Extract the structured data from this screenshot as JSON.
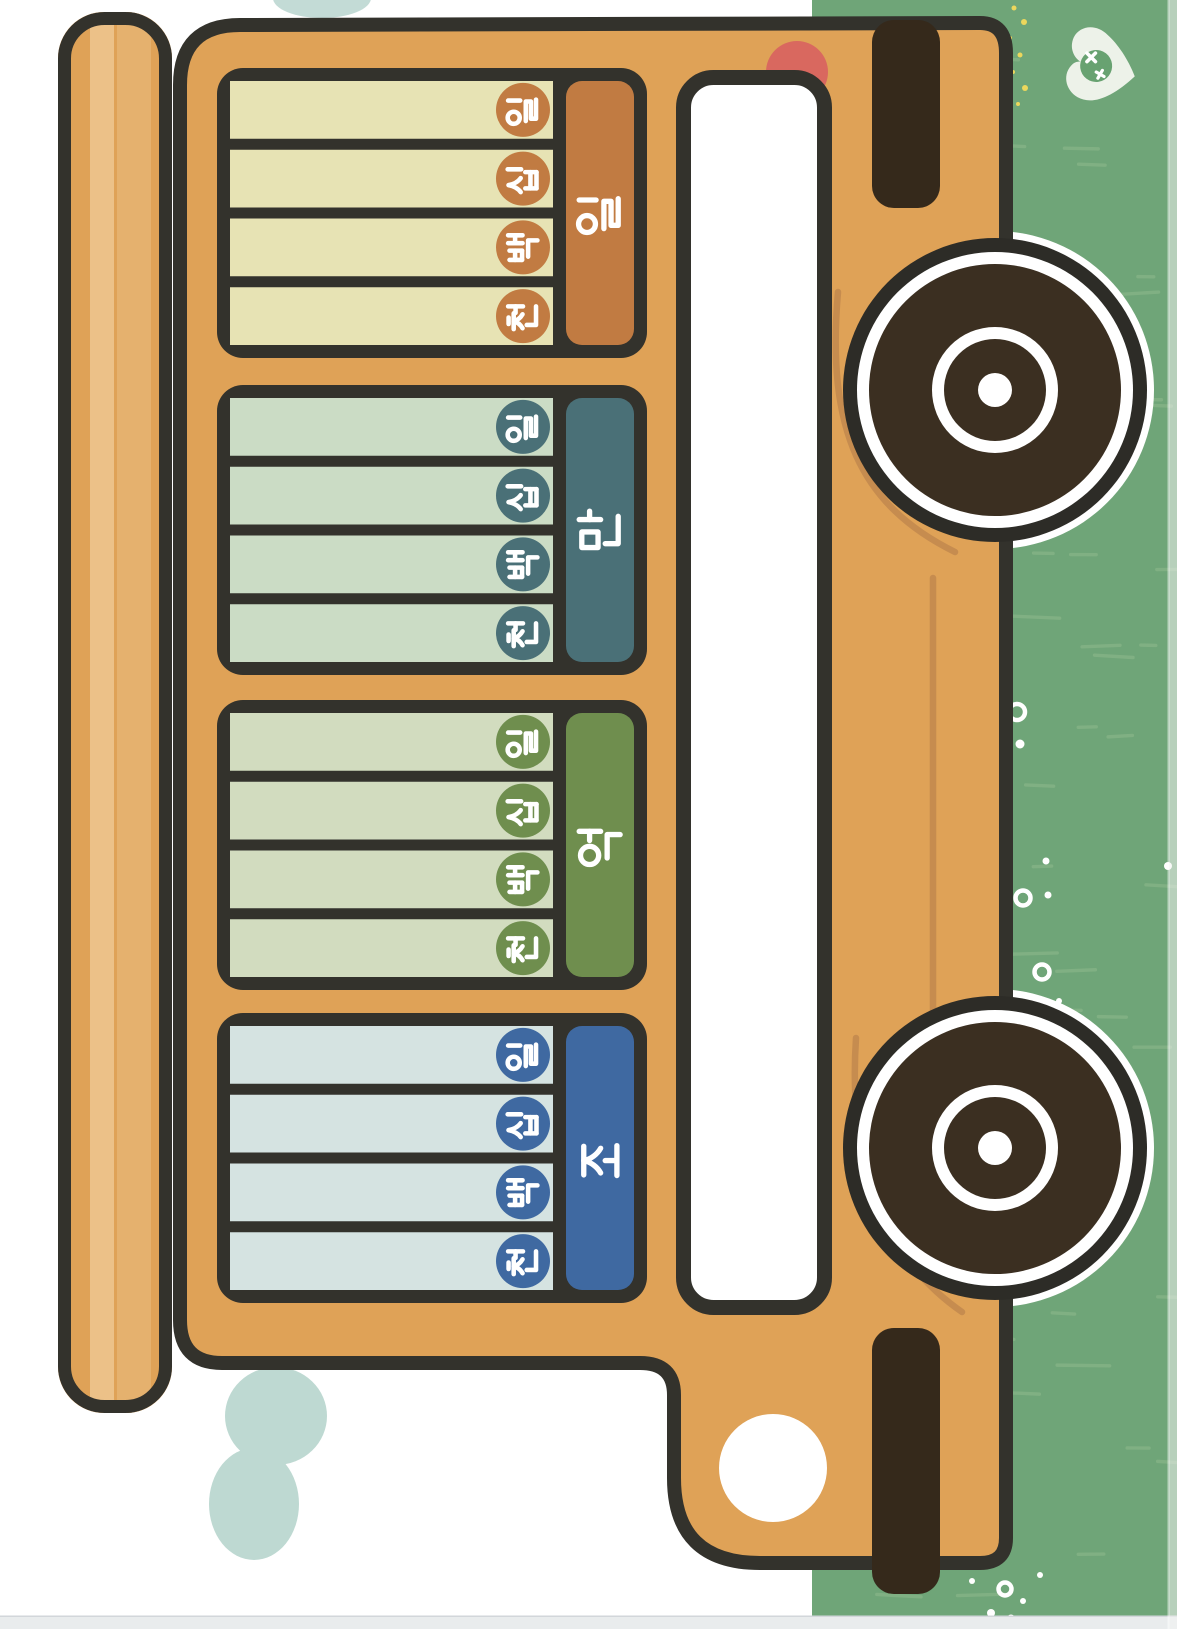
{
  "page": {
    "kind": "printable-worksheet",
    "background": "#ffffff",
    "bottom_edge_strip_color": "#e9eced"
  },
  "worksheet": {
    "theme": "korean-place-value-school-bus",
    "groups": [
      {
        "id": "il",
        "header_char": "일",
        "accent": "#c17b42",
        "row_fill": "#e7e3b4",
        "rows": [
          {
            "char": "일"
          },
          {
            "char": "십"
          },
          {
            "char": "백"
          },
          {
            "char": "천"
          }
        ]
      },
      {
        "id": "man",
        "header_char": "만",
        "accent": "#4a7077",
        "row_fill": "#cbdcc5",
        "rows": [
          {
            "char": "일"
          },
          {
            "char": "십"
          },
          {
            "char": "백"
          },
          {
            "char": "천"
          }
        ]
      },
      {
        "id": "eok",
        "header_char": "억",
        "accent": "#6f8e4e",
        "row_fill": "#d2dcbf",
        "rows": [
          {
            "char": "일"
          },
          {
            "char": "십"
          },
          {
            "char": "백"
          },
          {
            "char": "천"
          }
        ]
      },
      {
        "id": "jo",
        "header_char": "조",
        "accent": "#3f69a1",
        "row_fill": "#d5e3e1",
        "rows": [
          {
            "char": "일"
          },
          {
            "char": "십"
          },
          {
            "char": "백"
          },
          {
            "char": "천"
          }
        ]
      }
    ]
  },
  "bus": {
    "body_color": "#dfa257",
    "outline_color": "#33322c",
    "roof_stripe_colors": [
      "#ecc188",
      "#e5b16e"
    ],
    "window_color": "#ffffff",
    "wheel_dark_color": "#3b2f21",
    "wheel_rim_color": "#2d2c27",
    "bumper_color": "#35291b",
    "taillight_color": "#d9685f",
    "headlight_color": "#ffffff",
    "detail_line_color": "#c68c4f"
  },
  "scene": {
    "grass_color": "#6fa578",
    "grass_stroke_color": "#84b285",
    "smoke_color": "#bed9d2",
    "leaf_badge_color": "#edf2e9",
    "leaf_inner_color": "#68a271",
    "sparkle_dot_yellow": "#ecd75c",
    "dot_white": "#ffffff"
  },
  "icons": [
    "hangul-il-glyph",
    "hangul-sip-glyph",
    "hangul-baek-glyph",
    "hangul-cheon-glyph",
    "hangul-man-glyph",
    "hangul-eok-glyph",
    "hangul-jo-glyph",
    "wheel-icon",
    "leaf-badge-icon",
    "sparkle-x-icon",
    "headlight-icon",
    "taillight-icon",
    "bumper-icon",
    "smoke-cloud-icon"
  ]
}
